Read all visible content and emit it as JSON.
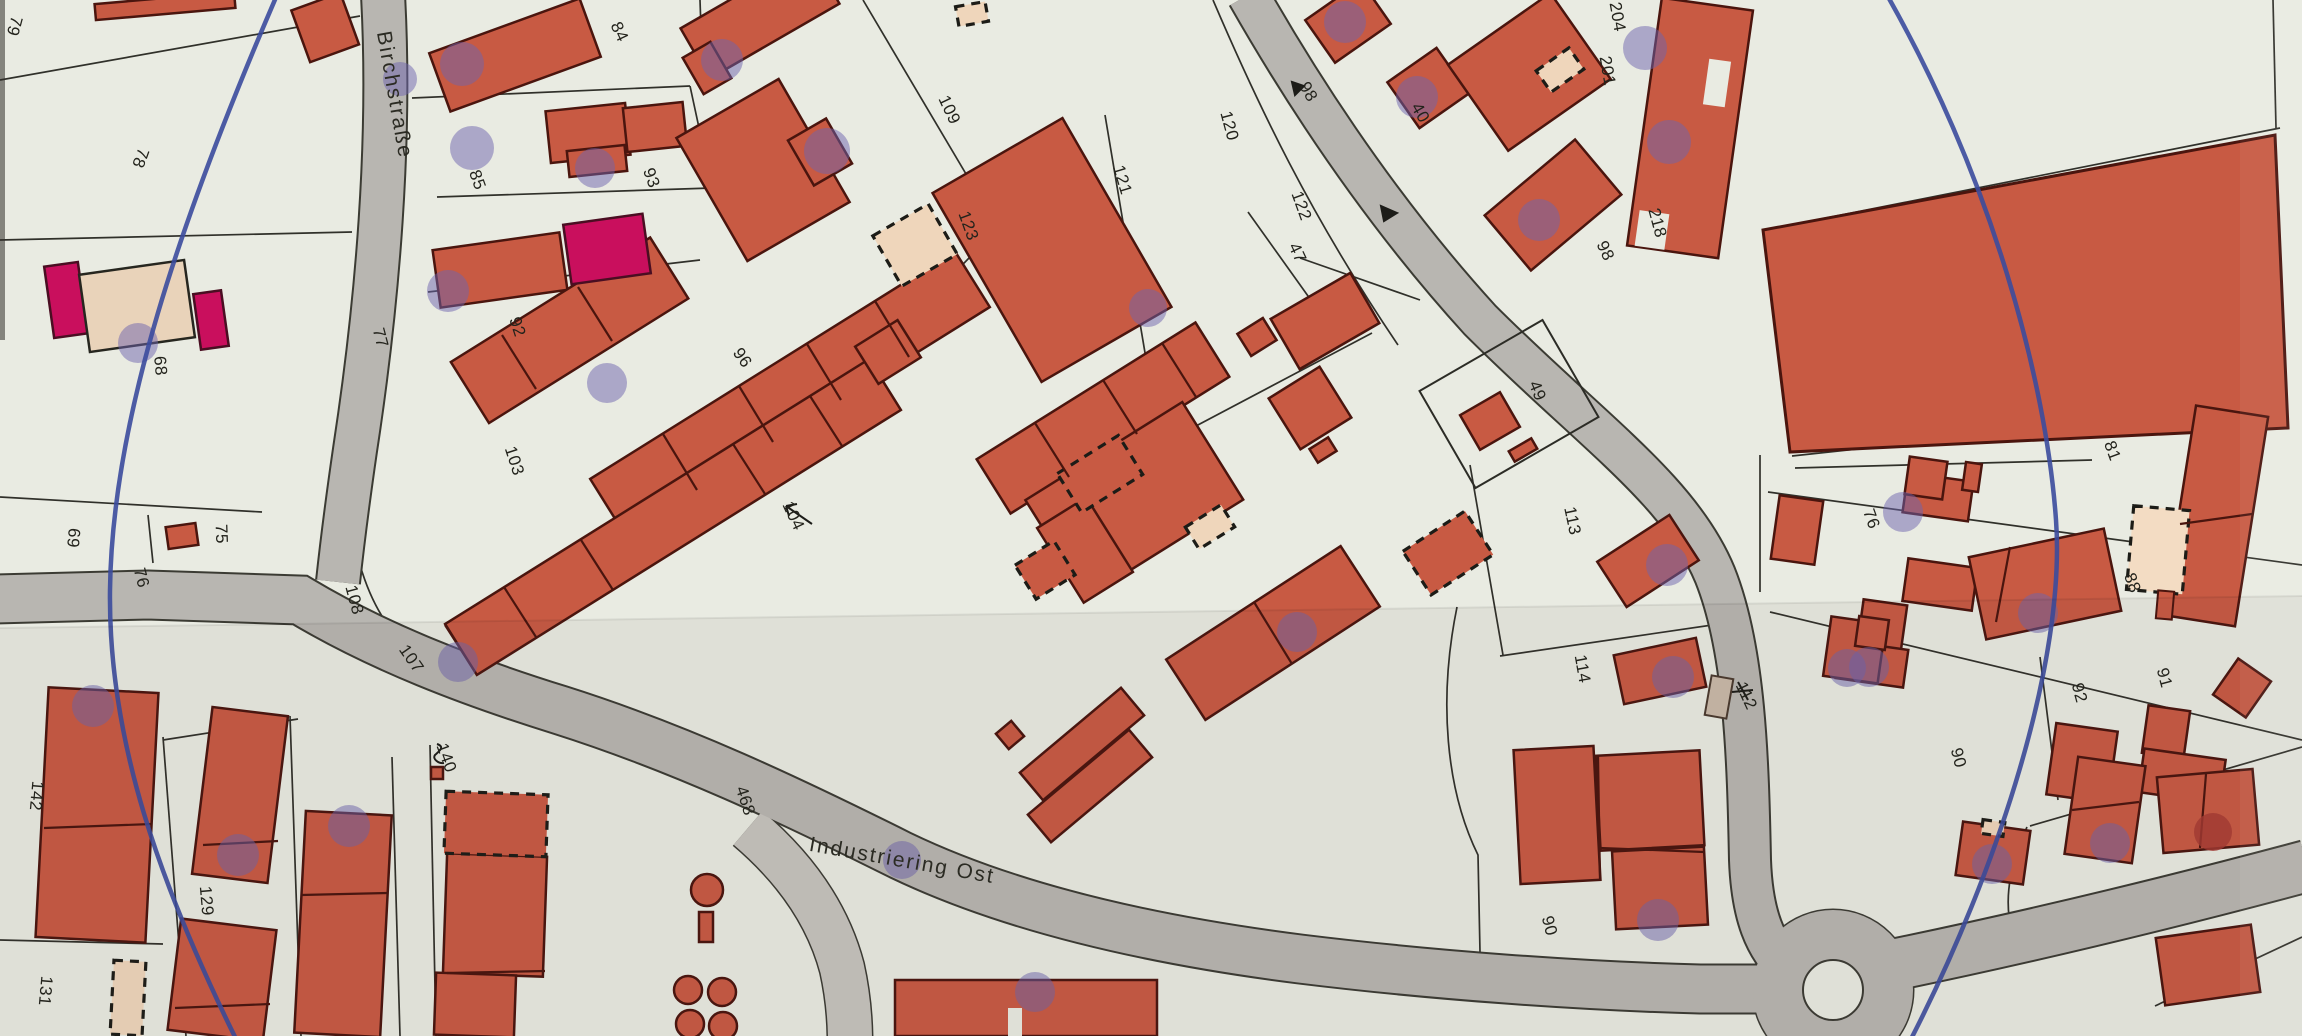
{
  "document": {
    "kind": "scanned cadastral map",
    "streets": [
      {
        "name": "Birchstraße"
      },
      {
        "name": "Industriering Ost"
      }
    ]
  },
  "colors": {
    "paper": "#e9ebe2",
    "road": "#b8b6b1",
    "road_edge": "#3b3b33",
    "building_red": "#c85a43",
    "building_outline": "#4a150e",
    "building_magenta": "#c90f5d",
    "building_beige": "#efd6bb",
    "pen_blue": "#3b4b9d",
    "marker_purple": "#6e64ae",
    "marker_dark_red": "#a63a33",
    "label_text": "#23231c"
  },
  "labels": [
    {
      "text": "79",
      "x": 14,
      "y": 26,
      "rot": 105
    },
    {
      "text": "78",
      "x": 140,
      "y": 158,
      "rot": 110
    },
    {
      "text": "84",
      "x": 619,
      "y": 32,
      "rot": 65
    },
    {
      "text": "85",
      "x": 477,
      "y": 180,
      "rot": 70
    },
    {
      "text": "93",
      "x": 651,
      "y": 178,
      "rot": 70
    },
    {
      "text": "92",
      "x": 517,
      "y": 327,
      "rot": 72
    },
    {
      "text": "77",
      "x": 380,
      "y": 338,
      "rot": 75
    },
    {
      "text": "68",
      "x": 160,
      "y": 366,
      "rot": 85
    },
    {
      "text": "109",
      "x": 949,
      "y": 110,
      "rot": 65
    },
    {
      "text": "123",
      "x": 968,
      "y": 226,
      "rot": 70
    },
    {
      "text": "121",
      "x": 1122,
      "y": 180,
      "rot": 73
    },
    {
      "text": "120",
      "x": 1229,
      "y": 126,
      "rot": 75
    },
    {
      "text": "122",
      "x": 1301,
      "y": 206,
      "rot": 70
    },
    {
      "text": "47",
      "x": 1297,
      "y": 253,
      "rot": 65
    },
    {
      "text": "98",
      "x": 1308,
      "y": 92,
      "rot": 60
    },
    {
      "text": "40",
      "x": 1420,
      "y": 113,
      "rot": 60
    },
    {
      "text": "204",
      "x": 1617,
      "y": 17,
      "rot": 80
    },
    {
      "text": "201",
      "x": 1607,
      "y": 71,
      "rot": 80
    },
    {
      "text": "218",
      "x": 1657,
      "y": 223,
      "rot": 75
    },
    {
      "text": "98",
      "x": 1605,
      "y": 251,
      "rot": 65
    },
    {
      "text": "96",
      "x": 742,
      "y": 358,
      "rot": 55
    },
    {
      "text": "104",
      "x": 793,
      "y": 516,
      "rot": 65
    },
    {
      "text": "103",
      "x": 514,
      "y": 461,
      "rot": 72
    },
    {
      "text": "75",
      "x": 221,
      "y": 534,
      "rot": 88
    },
    {
      "text": "69",
      "x": 73,
      "y": 538,
      "rot": 95
    },
    {
      "text": "76",
      "x": 141,
      "y": 578,
      "rot": 75
    },
    {
      "text": "108",
      "x": 354,
      "y": 600,
      "rot": 75
    },
    {
      "text": "107",
      "x": 411,
      "y": 659,
      "rot": 55
    },
    {
      "text": "49",
      "x": 1537,
      "y": 391,
      "rot": 68
    },
    {
      "text": "113",
      "x": 1572,
      "y": 521,
      "rot": 78
    },
    {
      "text": "114",
      "x": 1582,
      "y": 669,
      "rot": 80
    },
    {
      "text": "112",
      "x": 1746,
      "y": 696,
      "rot": 65
    },
    {
      "text": "81",
      "x": 2112,
      "y": 451,
      "rot": 70
    },
    {
      "text": "76",
      "x": 1871,
      "y": 519,
      "rot": 70
    },
    {
      "text": "88",
      "x": 2132,
      "y": 583,
      "rot": 70
    },
    {
      "text": "91",
      "x": 2164,
      "y": 678,
      "rot": 75
    },
    {
      "text": "92",
      "x": 2079,
      "y": 693,
      "rot": 75
    },
    {
      "text": "90",
      "x": 1958,
      "y": 758,
      "rot": 75
    },
    {
      "text": "90",
      "x": 1549,
      "y": 926,
      "rot": 75
    },
    {
      "text": "142",
      "x": 36,
      "y": 796,
      "rot": 95
    },
    {
      "text": "129",
      "x": 206,
      "y": 901,
      "rot": 85
    },
    {
      "text": "131",
      "x": 45,
      "y": 991,
      "rot": 95
    },
    {
      "text": "140",
      "x": 446,
      "y": 758,
      "rot": 70
    },
    {
      "text": "468",
      "x": 745,
      "y": 801,
      "rot": 72
    },
    {
      "text": "Birchstraße",
      "x": 394,
      "y": 95,
      "rot": 80
    },
    {
      "text": "Industriering Ost",
      "x": 902,
      "y": 861,
      "rot": 10
    }
  ],
  "annotations": {
    "pen_circle_color": "#3b4b9d",
    "dots": [
      [
        462,
        64,
        22
      ],
      [
        400,
        79,
        17
      ],
      [
        472,
        148,
        22
      ],
      [
        595,
        168,
        20
      ],
      [
        722,
        60,
        21
      ],
      [
        827,
        151,
        23
      ],
      [
        448,
        291,
        21
      ],
      [
        607,
        383,
        20
      ],
      [
        458,
        662,
        20
      ],
      [
        1148,
        308,
        19
      ],
      [
        1345,
        22,
        21
      ],
      [
        1417,
        97,
        21
      ],
      [
        1645,
        48,
        22
      ],
      [
        1669,
        142,
        22
      ],
      [
        1539,
        220,
        21
      ],
      [
        1667,
        565,
        21
      ],
      [
        1673,
        677,
        21
      ],
      [
        1658,
        920,
        21
      ],
      [
        1992,
        864,
        20
      ],
      [
        2110,
        843,
        20
      ],
      [
        1903,
        512,
        20
      ],
      [
        1869,
        667,
        20
      ],
      [
        2038,
        613,
        20
      ],
      [
        1297,
        632,
        20
      ],
      [
        1847,
        668,
        19
      ],
      [
        238,
        855,
        21
      ],
      [
        349,
        826,
        21
      ],
      [
        93,
        706,
        21
      ],
      [
        138,
        343,
        20
      ],
      [
        902,
        860,
        19
      ],
      [
        1035,
        992,
        20
      ],
      [
        2213,
        832,
        19,
        "#a63a33"
      ]
    ]
  }
}
